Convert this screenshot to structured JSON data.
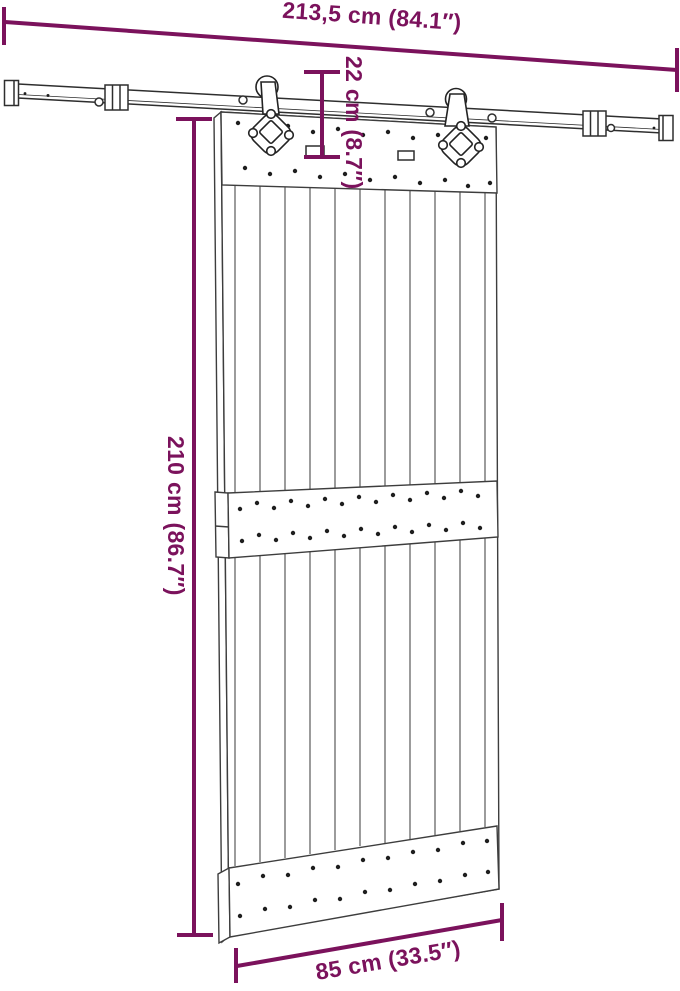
{
  "diagram": {
    "labels": {
      "track_width": "213,5 cm (84.1″)",
      "drop_height": "22 cm (8.7″)",
      "door_height": "210 cm (86.7″)",
      "door_width": "85 cm (33.5″)"
    },
    "colors": {
      "dimension_accent": "#7b125c",
      "line_art": "#2e2e2e",
      "background": "#ffffff"
    }
  }
}
